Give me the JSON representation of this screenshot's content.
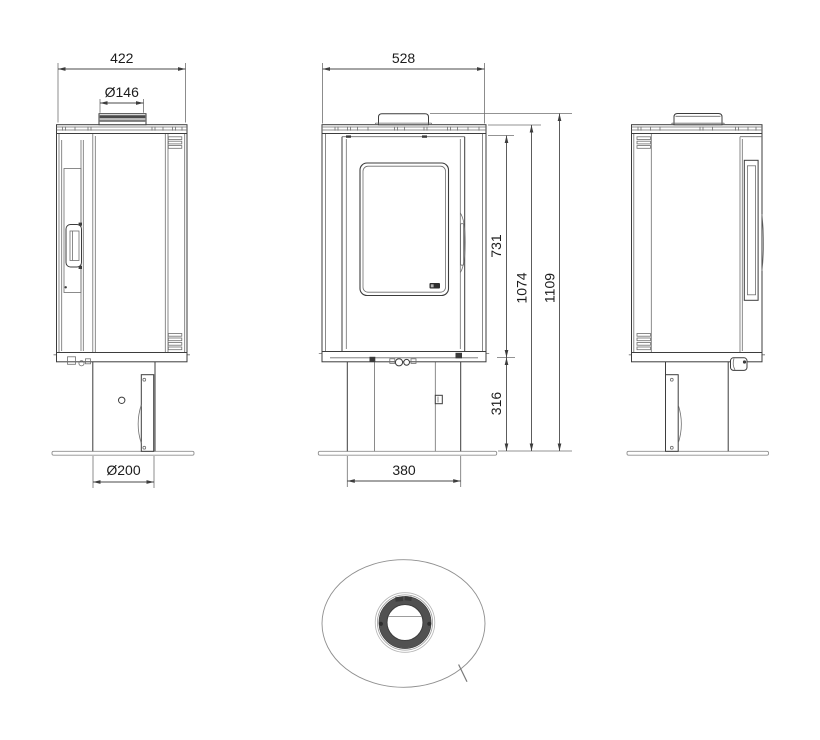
{
  "meta": {
    "type": "technical orthographic drawing",
    "subject": "free-standing oval wood-burning stove, dimensioned views",
    "units": "mm",
    "views": [
      "left side view",
      "front view",
      "right side view",
      "top view"
    ]
  },
  "colors": {
    "background": "#ffffff",
    "line_dark": "#3d3d3d",
    "line_light": "#8f8f8f",
    "text": "#1c1c1c"
  },
  "dimensions": {
    "top_plate_depth": "422",
    "flue_diameter": "Ø146",
    "top_plate_width": "528",
    "firebox_height": "731",
    "body_height": "1074",
    "total_height": "1109",
    "pedestal_height": "316",
    "pedestal_depth": "Ø200",
    "pedestal_width": "380"
  }
}
